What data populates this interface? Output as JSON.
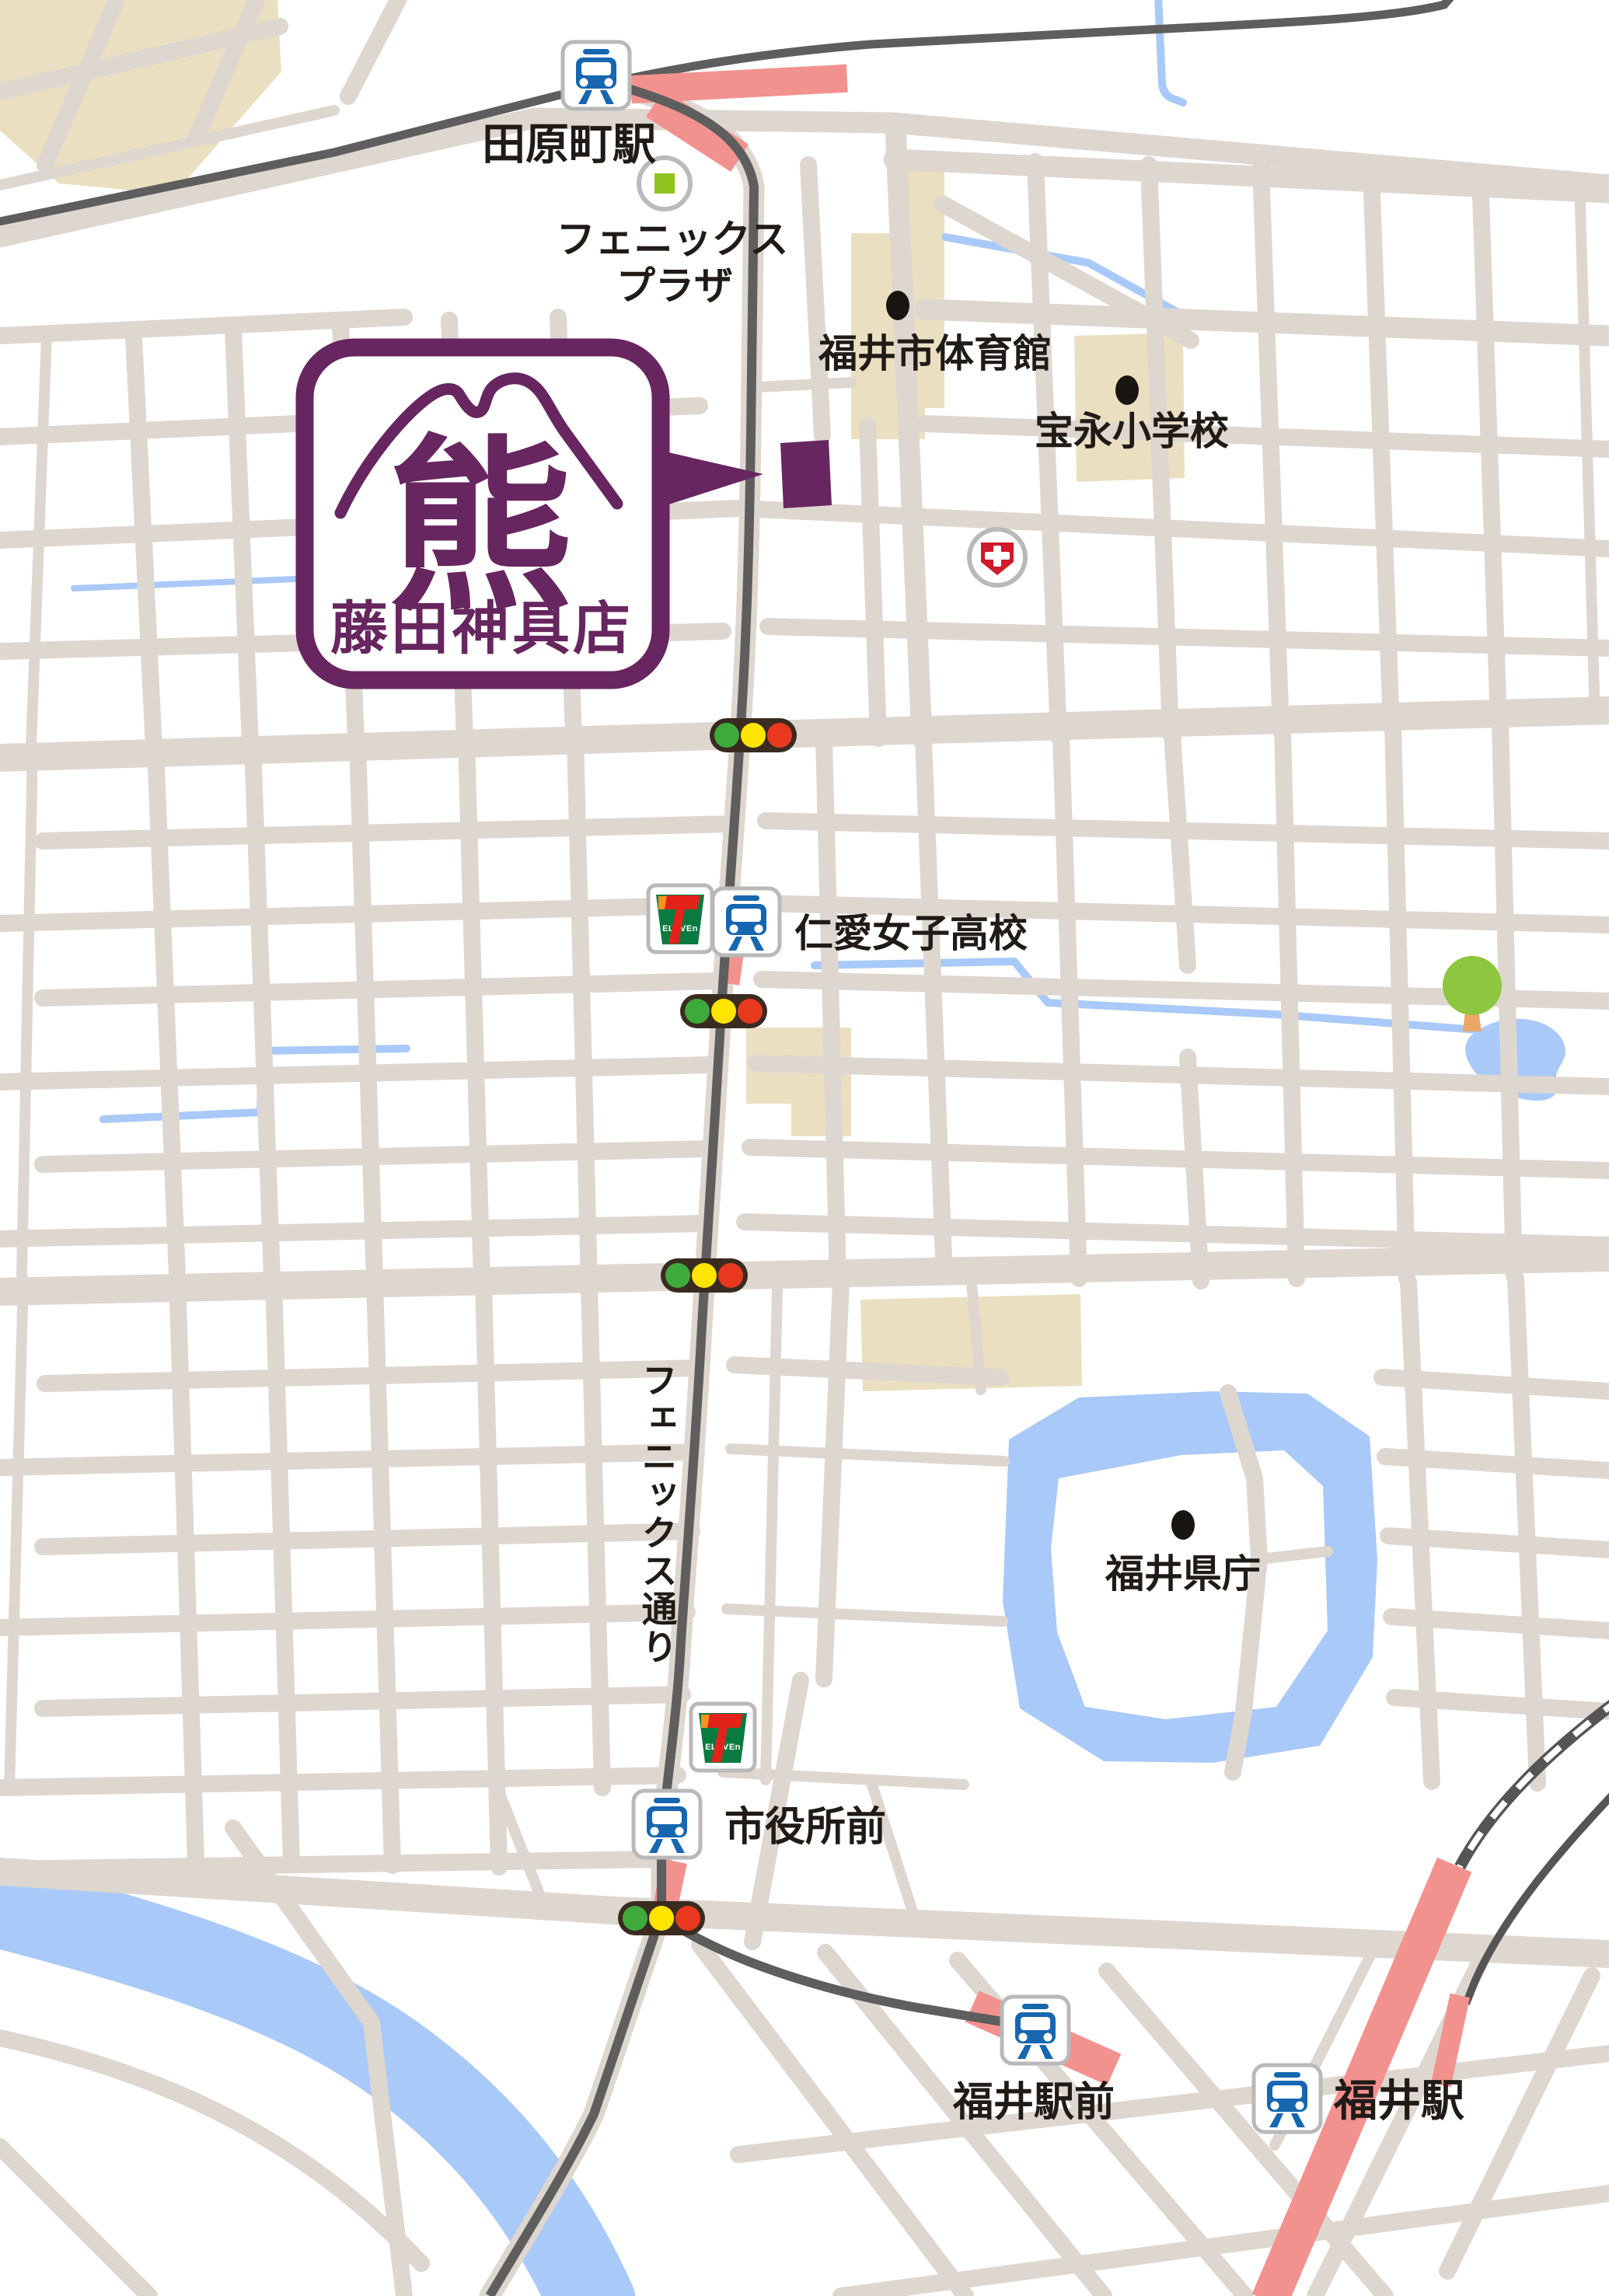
{
  "map": {
    "shop": {
      "name": "藤田神具店",
      "emblem": "熊"
    },
    "labels": {
      "tawaramachi_station": "田原町駅",
      "phoenix_plaza_line1": "フェニックス",
      "phoenix_plaza_line2": "プラザ",
      "city_gymnasium": "福井市体育館",
      "hoei_elementary": "宝永小学校",
      "jinai_girls_high_school": "仁愛女子高校",
      "phoenix_street": "フェニックス通り",
      "fukui_prefectural_office": "福井県庁",
      "shiyakusho_mae": "市役所前",
      "fukui_ekimae": "福井駅前",
      "fukui_station": "福井駅"
    },
    "seven_eleven": {
      "seven": "7",
      "eleven": "ELEVEn"
    },
    "colors": {
      "accent_purple": "#67265f",
      "rail_pink": "#f2928f",
      "water_blue": "#a9c9f8",
      "building_beige": "#eae0c1",
      "road_gray": "#ded7d0",
      "tram_dark": "#5e5e5e",
      "train_blue": "#1666b0",
      "traffic_green": "#3faa3c",
      "traffic_yellow": "#ffe400",
      "traffic_red": "#e8391e",
      "plaza_green": "#8fc31f",
      "tree_green": "#8dc63f",
      "hospital_red": "#cf1a2b",
      "seven_green": "#0a7a40",
      "seven_orange": "#f7941d",
      "seven_red": "#e32219",
      "poi_dot": "#181512"
    },
    "icons": {
      "train": "train-icon",
      "seven_eleven": "seven-eleven-icon",
      "traffic_light": "traffic-light-icon",
      "hospital": "hospital-icon",
      "phoenix_plaza": "phoenix-plaza-icon",
      "tree": "tree-icon",
      "poi_dot": "poi-dot-icon",
      "shop_marker": "shop-location-marker",
      "platform": "station-platform"
    }
  }
}
